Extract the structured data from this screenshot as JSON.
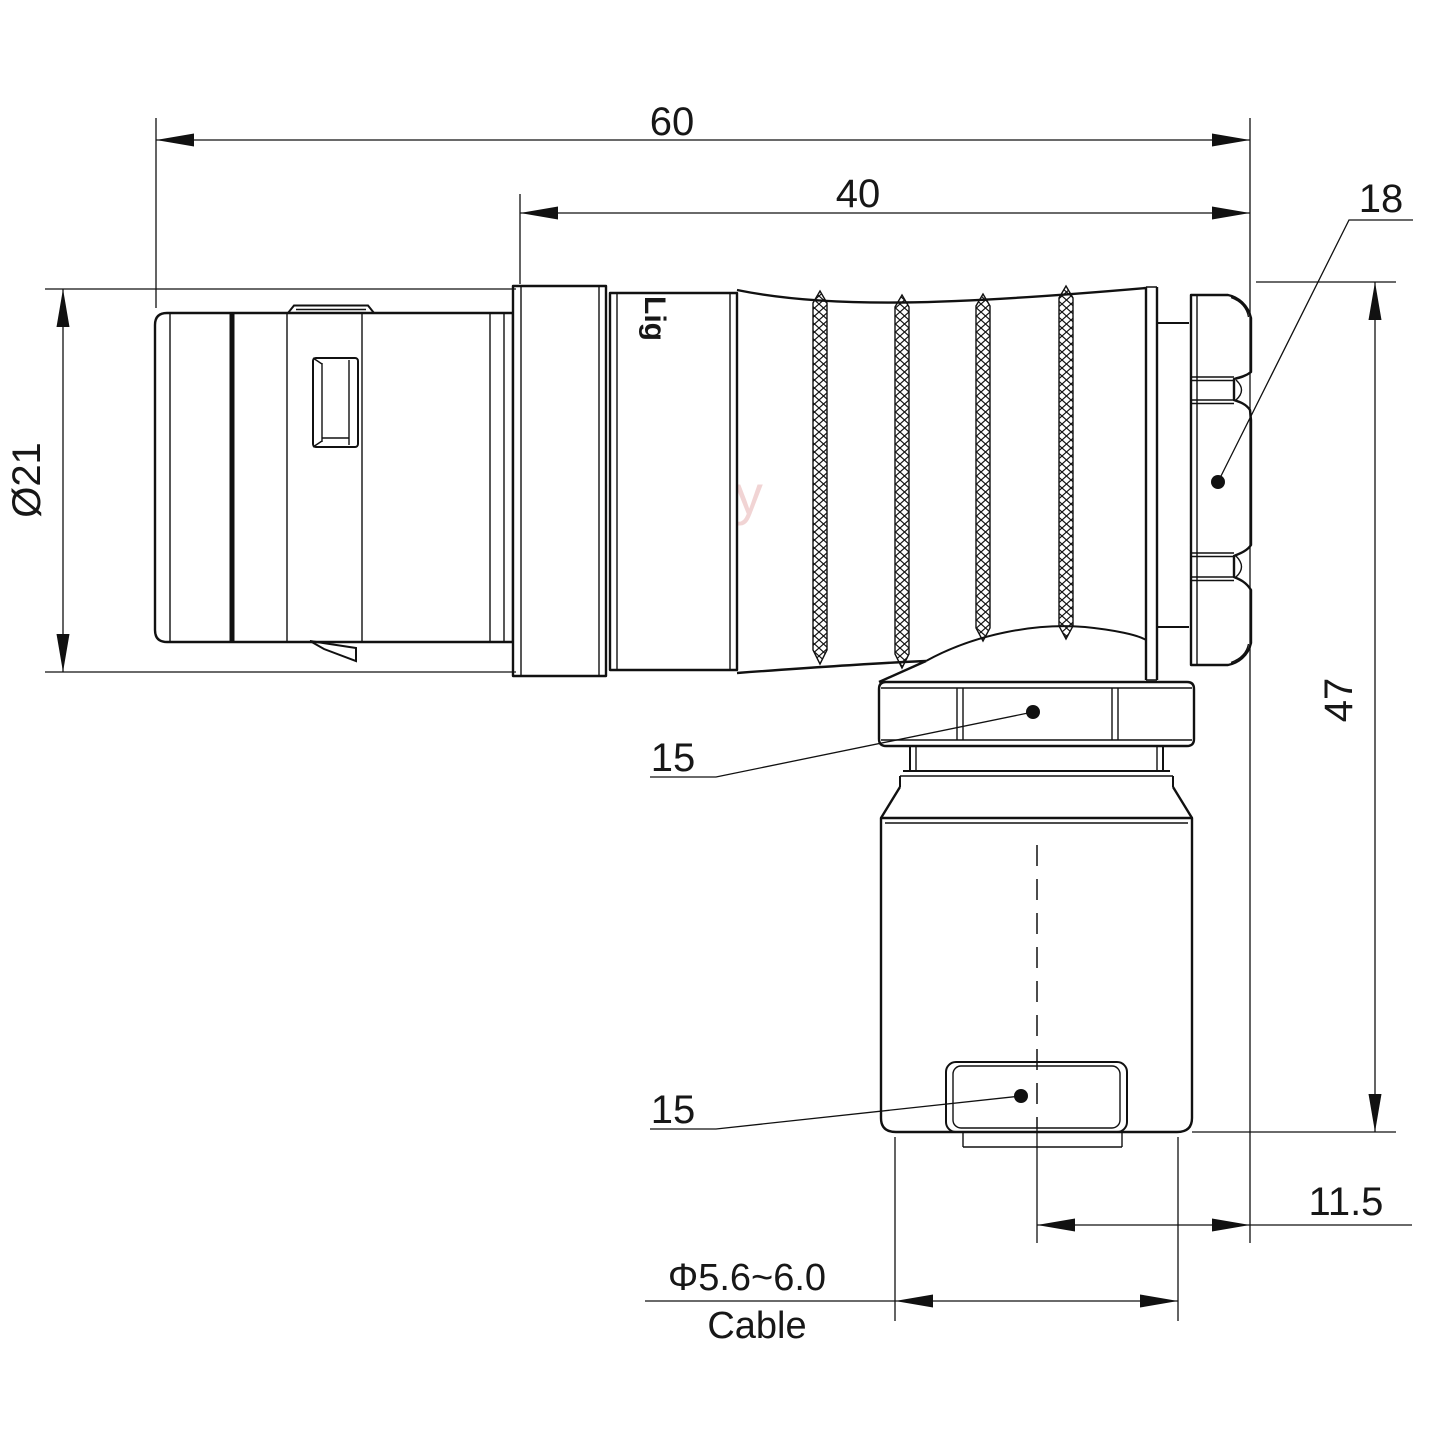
{
  "drawing": {
    "watermark": "Lightany",
    "body_print": "Lig",
    "dimensions": {
      "overall_length": "60",
      "front_length": "40",
      "rear_nut_af": "18",
      "body_diameter": "Ø21",
      "total_height": "47",
      "coupling_nut_af": "15",
      "clamp_width": "15",
      "axis_offset": "11.5",
      "cable_diameter_range": "Φ5.6~6.0",
      "cable_label": "Cable"
    }
  }
}
